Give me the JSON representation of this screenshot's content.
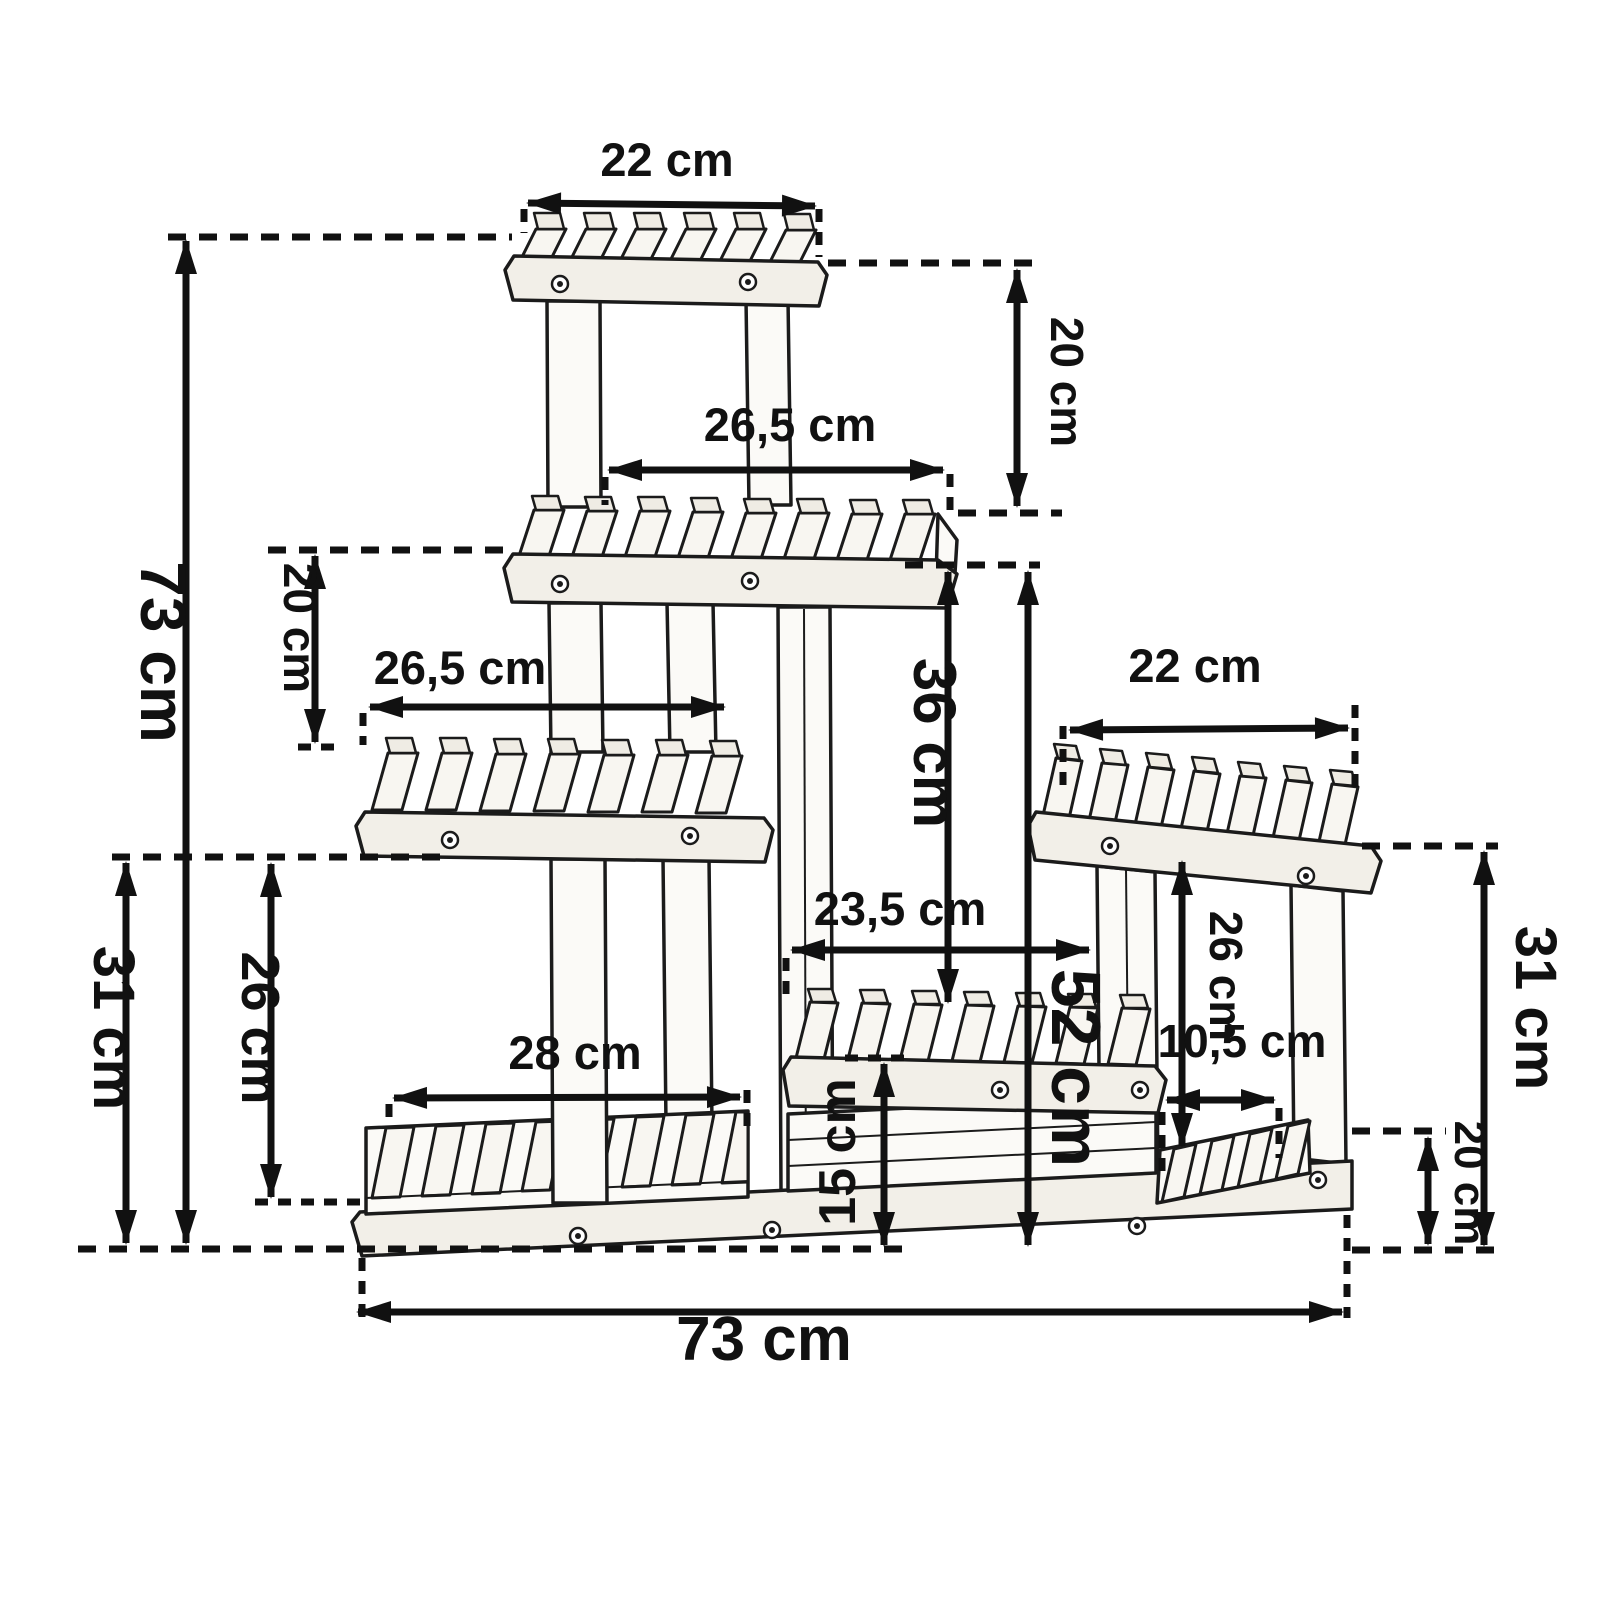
{
  "meta": {
    "type": "technical-dimension-diagram",
    "subject": "multi-tier wooden flower / plant stand",
    "unit": "cm",
    "colors": {
      "line": "#111111",
      "wood": "#fbfaf7",
      "rail": "#f2efe8",
      "background": "#ffffff"
    }
  },
  "labels": {
    "top_shelf_width": "22 cm",
    "tier1_tier2_gap": "20 cm",
    "tier2_width": "26,5 cm",
    "tier2_tier3_gap": "20 cm",
    "tier3_width": "26,5 cm",
    "total_height": "73 cm",
    "left_section_height": "31 cm",
    "tier3_to_bottom_shelf": "26 cm",
    "bottom_shelf_width": "28 cm",
    "middle_height": "36 cm",
    "middle_shelf_width": "23,5 cm",
    "base_to_tier2_height": "52 cm",
    "middle_lower_height": "15 cm",
    "right_shelf_width": "22 cm",
    "right_inner_height": "26 cm",
    "right_inner_width": "10,5 cm",
    "right_section_height": "31 cm",
    "right_step_height": "20 cm",
    "total_width": "73 cm"
  }
}
